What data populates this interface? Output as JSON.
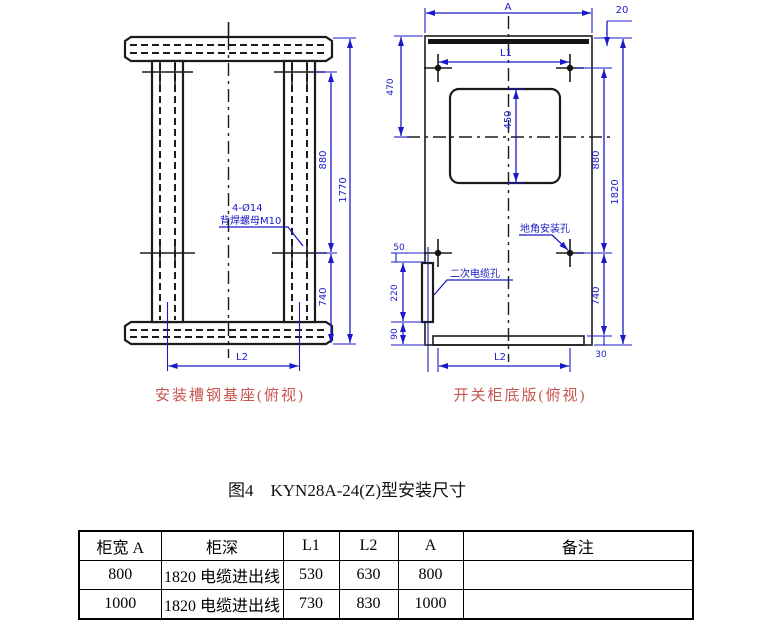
{
  "colors": {
    "dimension_blue": "#1a1ac8",
    "caption_red": "#c9544f",
    "drawing_black": "#1b1b1b",
    "page_background": "#ffffff"
  },
  "figure": {
    "caption": "图4　KYN28A-24(Z)型安装尺寸",
    "left": {
      "caption": "安装槽钢基座(俯视)",
      "note1": "4-Ø14",
      "note2": "背焊螺母M10",
      "d880": "880",
      "d1770": "1770",
      "d740": "740",
      "dL2": "L2"
    },
    "right": {
      "caption": "开关柜底版(俯视)",
      "cable_hole": "二次电缆孔",
      "anchor_hole": "地角安装孔",
      "dA": "A",
      "d20": "20",
      "dL1": "L1",
      "d470": "470",
      "d450": "450",
      "d880": "880",
      "d1820": "1820",
      "d740": "740",
      "d30": "30",
      "d50": "50",
      "d220": "220",
      "d90": "90",
      "dL2": "L2"
    }
  },
  "table": {
    "headers": [
      "柜宽 A",
      "柜深",
      "L1",
      "L2",
      "A",
      "备注"
    ],
    "rows": [
      [
        "800",
        "1820 电缆进出线",
        "530",
        "630",
        "800",
        ""
      ],
      [
        "1000",
        "1820 电缆进出线",
        "730",
        "830",
        "1000",
        ""
      ]
    ]
  }
}
